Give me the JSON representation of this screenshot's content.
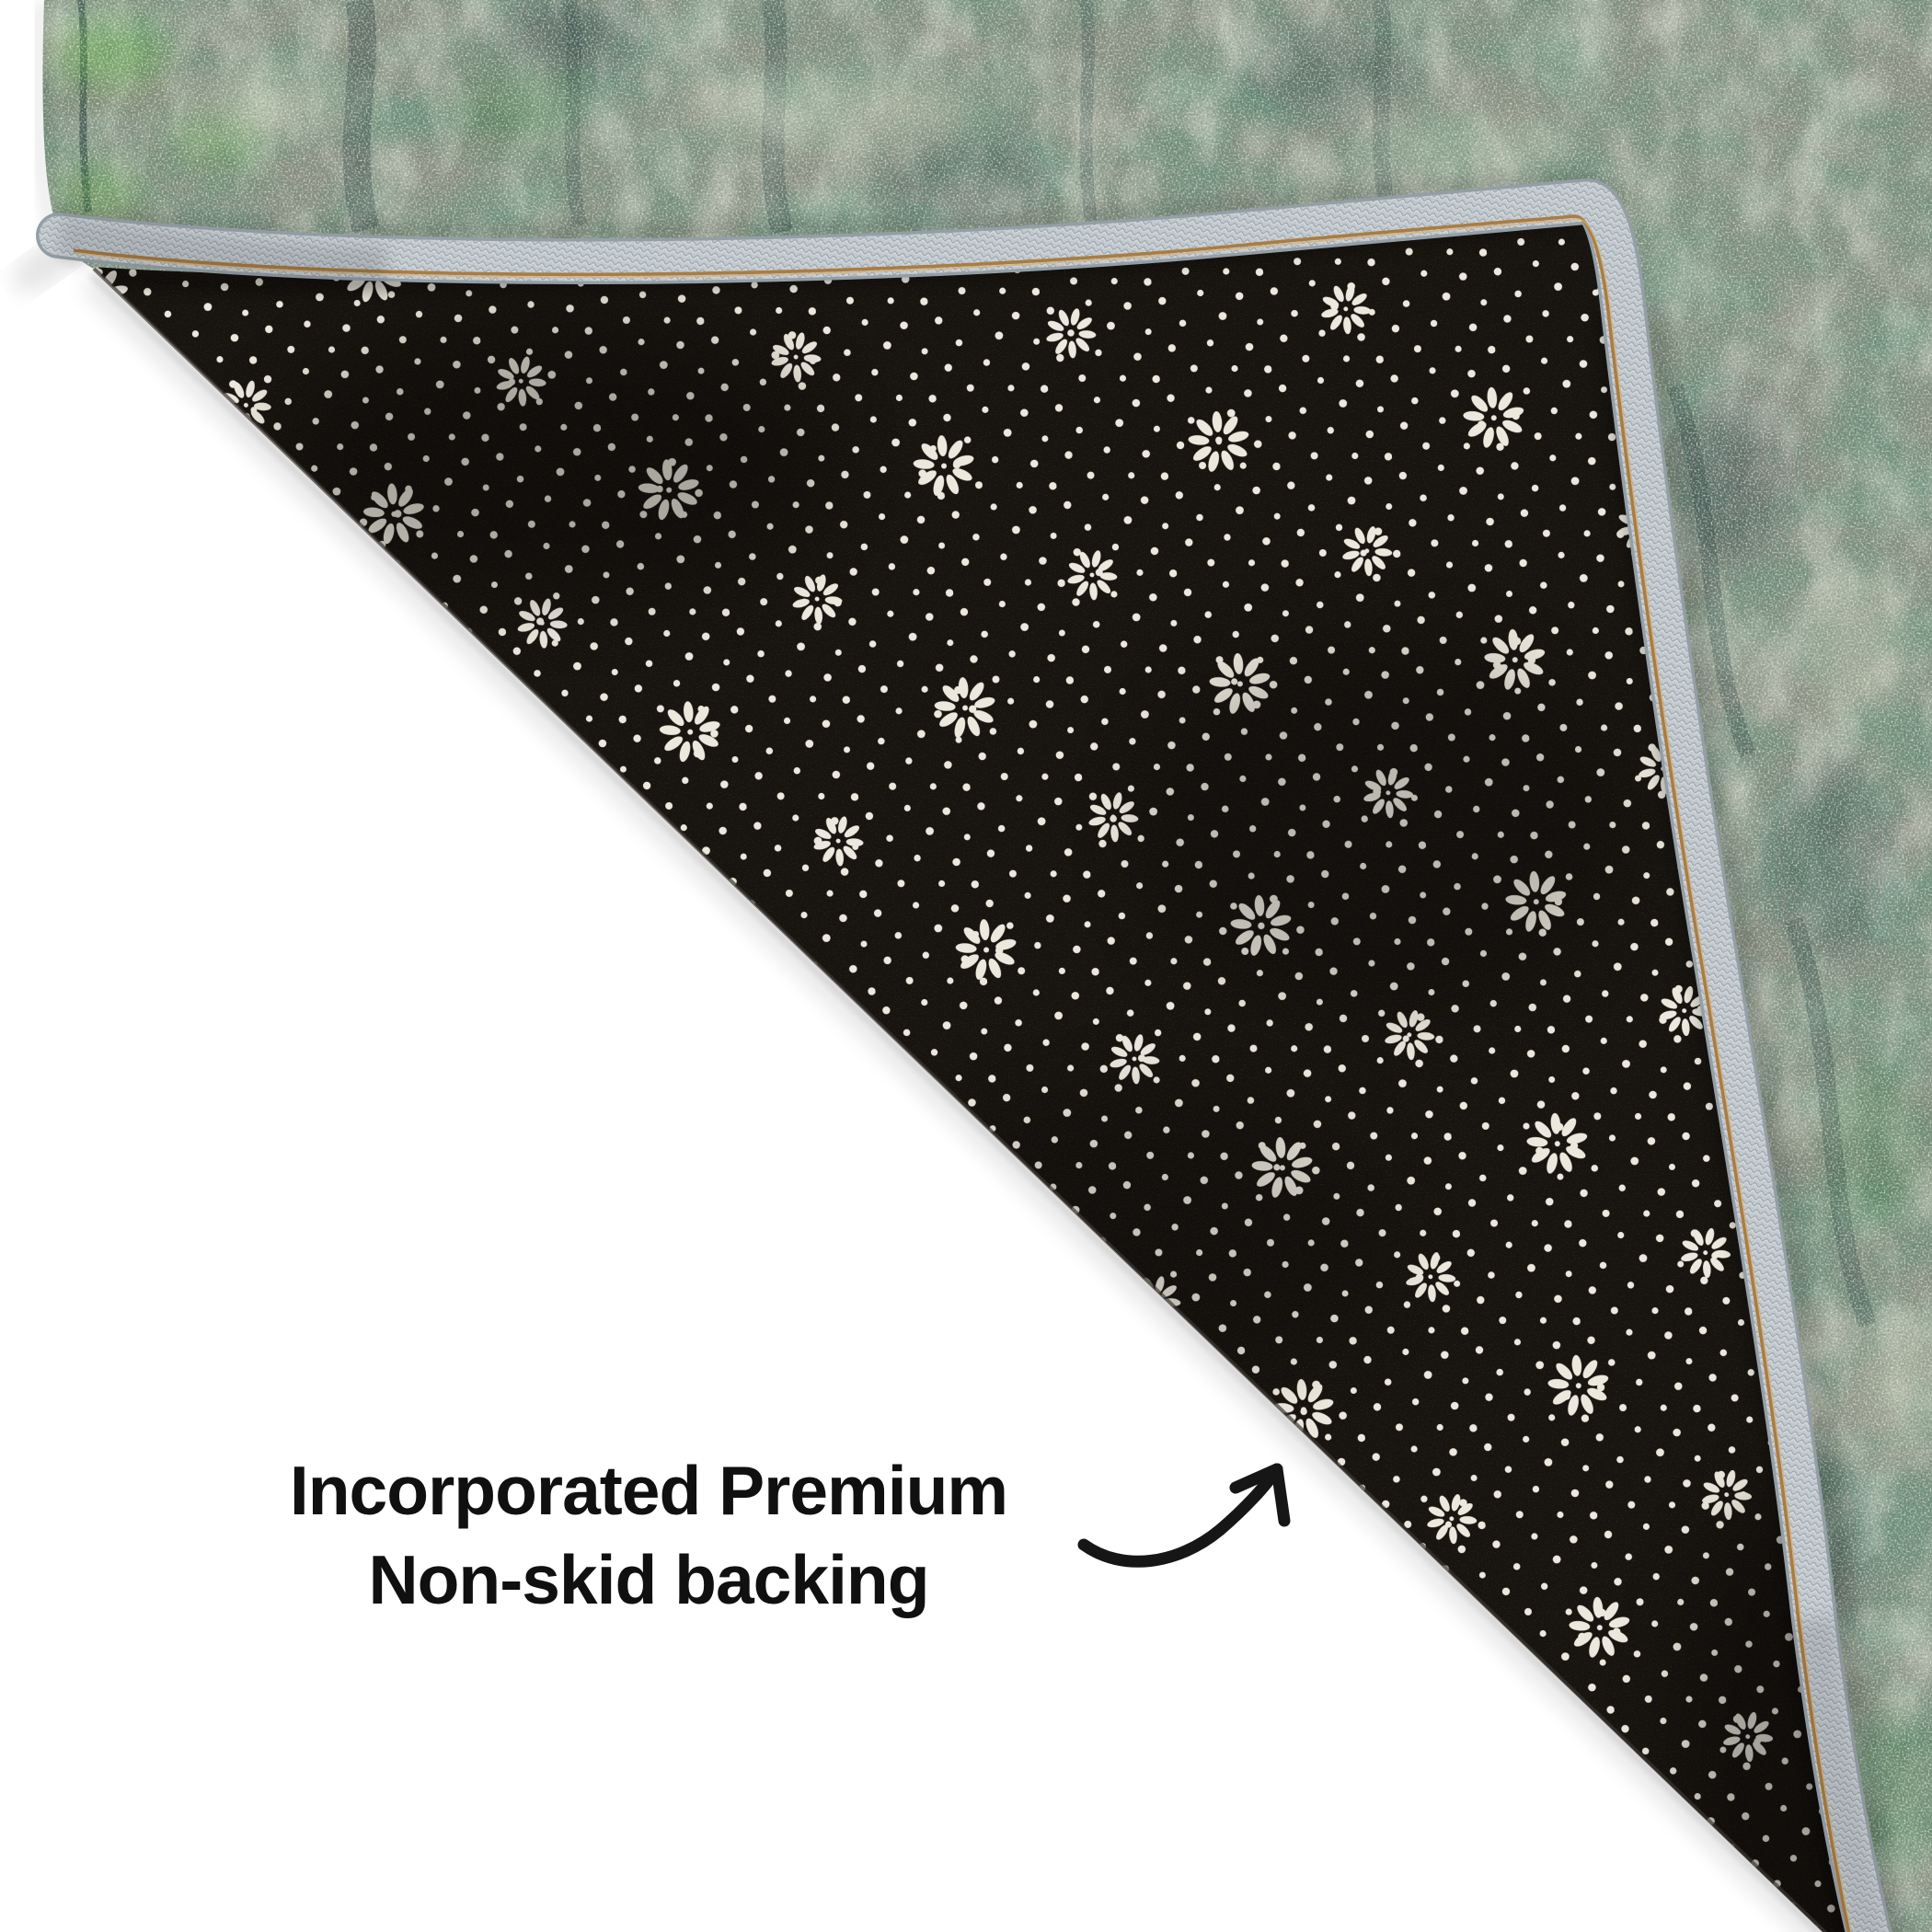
{
  "scene": {
    "background_color": "#ffffff",
    "shadow_color": "#000000",
    "description": "rug corner folded over showing non-skid backing"
  },
  "caption": {
    "line1": "Incorporated Premium",
    "line2": "Non-skid backing",
    "color": "#101010"
  },
  "arrow": {
    "icon": "curved-arrow-up-right",
    "color": "#161616"
  },
  "rug": {
    "front": {
      "base_color": "#8a9083",
      "patch_dark_green": "#2c4434",
      "patch_teal": "#22393d",
      "patch_bright_green": "#57a23b",
      "patch_mid_green": "#3f7a4a",
      "patch_cream": "#ccd0bc"
    },
    "edge_binding": {
      "base_color": "#c2c9ce",
      "rim_color": "#949ea5",
      "stitch_color": "#a87d44",
      "stitch_highlight": "#d8b077"
    },
    "backing": {
      "base_color": "#17130f",
      "dot_color": "#ece8dd",
      "texture": "non-skid dots and rosettes"
    }
  }
}
